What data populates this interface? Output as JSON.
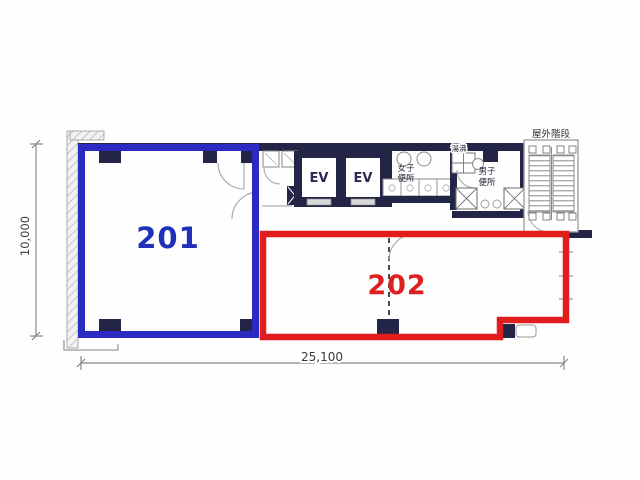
{
  "rooms": {
    "room201": {
      "number": "201"
    },
    "room202": {
      "number": "202"
    }
  },
  "core": {
    "elevator1_label": "EV",
    "elevator2_label": "EV",
    "womens_toilet_line1": "女子",
    "womens_toilet_line2": "便所",
    "mens_toilet_line1": "男子",
    "mens_toilet_line2": "便所",
    "hot_water_label": "湯沸",
    "outdoor_stairs_label": "屋外階段"
  },
  "dimensions": {
    "vertical": "10,000",
    "horizontal": "25,100"
  },
  "colors": {
    "room201_outline": "#2b2bc2",
    "room201_text": "#2130b8",
    "room202_outline": "#e21d1d",
    "room202_text": "#de2020",
    "wall": "#232547"
  }
}
